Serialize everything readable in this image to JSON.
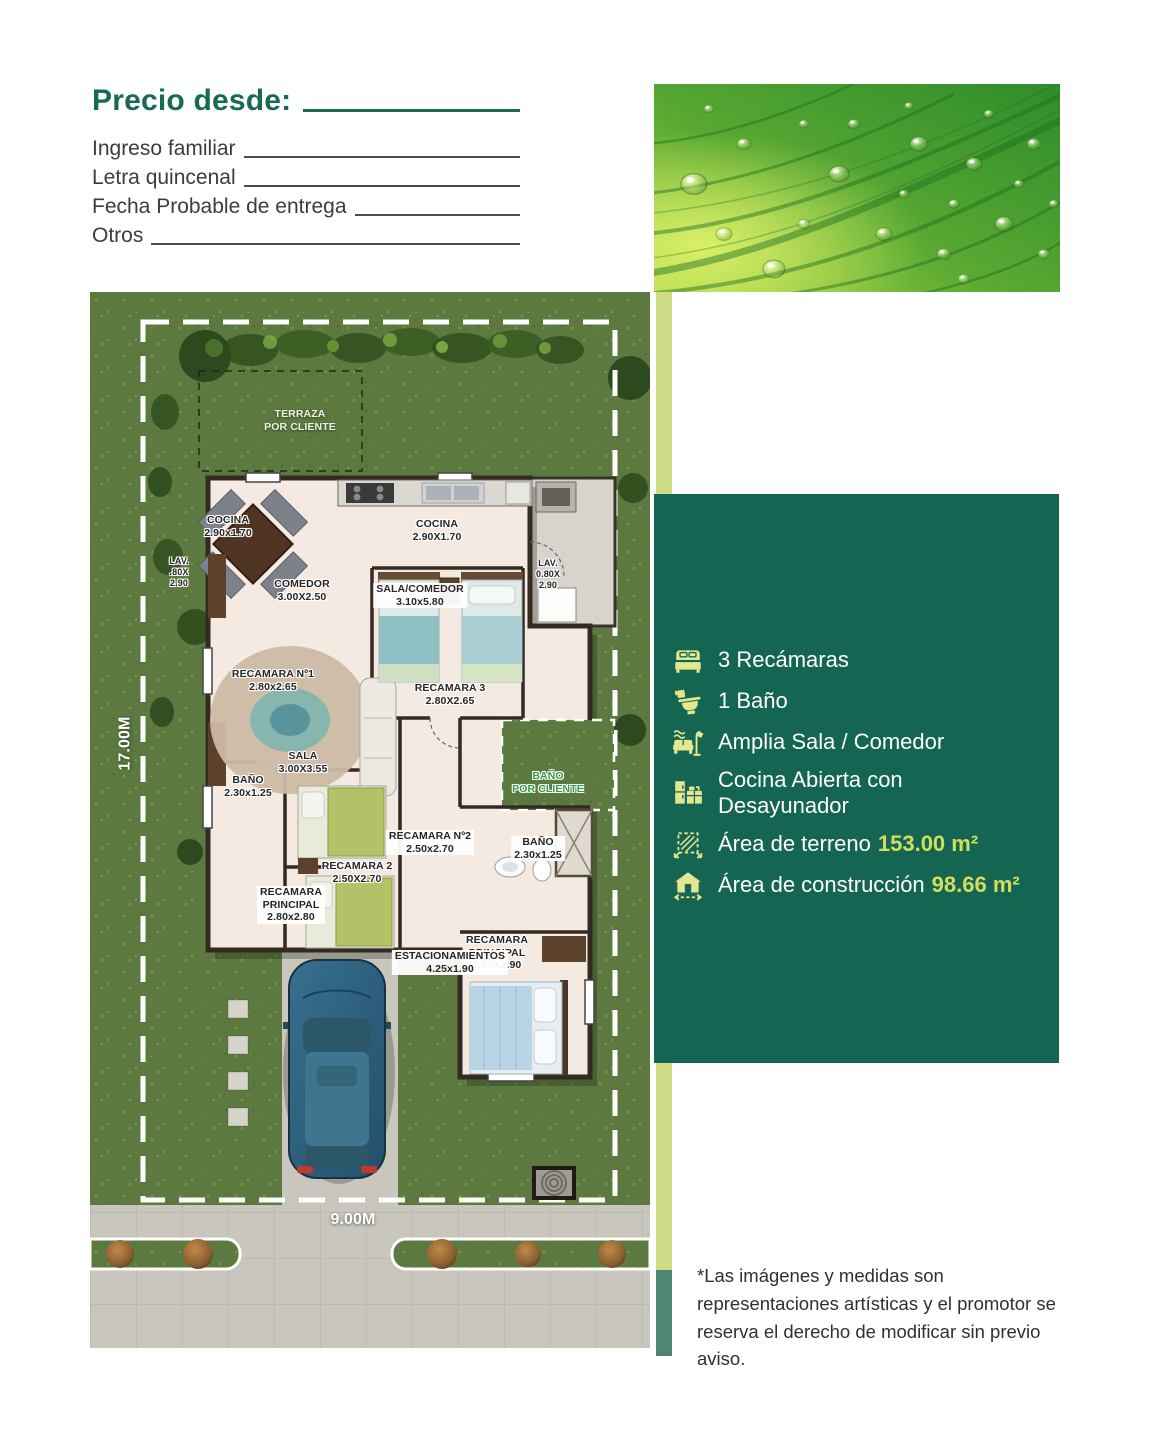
{
  "header": {
    "title": "Precio desde:",
    "fields": [
      {
        "label": "Ingreso familiar"
      },
      {
        "label": "Letra quincenal"
      },
      {
        "label": "Fecha Probable de entrega"
      },
      {
        "label": "Otros"
      }
    ]
  },
  "colors": {
    "brand_green": "#196a53",
    "panel_green": "#146551",
    "accent_light_strip": "#cedc86",
    "accent_teal_strip": "#4e8672",
    "value_yellow": "#d3de5f",
    "icon_yellow": "#e3e88f"
  },
  "panel": {
    "features": [
      {
        "icon": "bed-icon",
        "text": "3 Recámaras"
      },
      {
        "icon": "toilet-icon",
        "text": "1 Baño"
      },
      {
        "icon": "sofa-lamp-icon",
        "text": "Amplia Sala / Comedor"
      },
      {
        "icon": "kitchen-icon",
        "text": "Cocina Abierta con\nDesayunador"
      },
      {
        "icon": "land-area-icon",
        "text": "Área de terreno",
        "value": "153.00 m²"
      },
      {
        "icon": "construction-area-icon",
        "text": "Área de construcción",
        "value": "98.66 m²"
      }
    ]
  },
  "floorplan": {
    "labels": [
      {
        "id": "terraza",
        "text": "TERRAZA\nPOR CLIENTE",
        "style": "light"
      },
      {
        "id": "cocina-left",
        "text": "COCINA\n2.90x1.70",
        "style": "halo"
      },
      {
        "id": "cocina",
        "text": "COCINA\n2.90X1.70",
        "style": "halo"
      },
      {
        "id": "lav-left",
        "text": "LAV.\n.80X\n2.90",
        "style": "halo"
      },
      {
        "id": "lav-right",
        "text": "LAV.\n0.80X\n2.90",
        "style": "halo"
      },
      {
        "id": "comedor",
        "text": "COMEDOR\n3.00X2.50",
        "style": "halo"
      },
      {
        "id": "sala-comedor",
        "text": "SALA/COMEDOR\n3.10x5.80",
        "style": "box"
      },
      {
        "id": "recamara-1",
        "text": "RECAMARA Nº1\n2.80x2.65",
        "style": "halo"
      },
      {
        "id": "recamara-3",
        "text": "RECAMARA 3\n2.80X2.65",
        "style": "halo"
      },
      {
        "id": "sala",
        "text": "SALA\n3.00X3.55",
        "style": "halo"
      },
      {
        "id": "bano-left",
        "text": "BAÑO\n2.30x1.25",
        "style": "halo"
      },
      {
        "id": "bano-por-cliente",
        "text": "BAÑO\nPOR CLIENTE",
        "style": "green"
      },
      {
        "id": "recamara-2-n",
        "text": "RECAMARA Nº2\n2.50x2.70",
        "style": "box"
      },
      {
        "id": "bano-right",
        "text": "BAÑO\n2.30x1.25",
        "style": "box"
      },
      {
        "id": "recamara-2",
        "text": "RECAMARA 2\n2.50X2.70",
        "style": "halo"
      },
      {
        "id": "recamara-ppal-left",
        "text": "RECAMARA\nPRINCIPAL\n2.80x2.80",
        "style": "box"
      },
      {
        "id": "recamara-ppal-right",
        "text": "RECAMARA\nPRINCIPAL\n2.85X2.90",
        "style": "halo"
      },
      {
        "id": "estacionamientos",
        "text": "ESTACIONAMIENTOS\n4.25x1.90",
        "style": "box"
      },
      {
        "id": "dim-depth",
        "text": "17.00M",
        "style": "dim rotated"
      },
      {
        "id": "dim-width",
        "text": "9.00M",
        "style": "dim"
      }
    ]
  },
  "disclaimer": "*Las imágenes y medidas son representaciones artísticas y el promotor se reserva el derecho de modificar sin previo aviso."
}
